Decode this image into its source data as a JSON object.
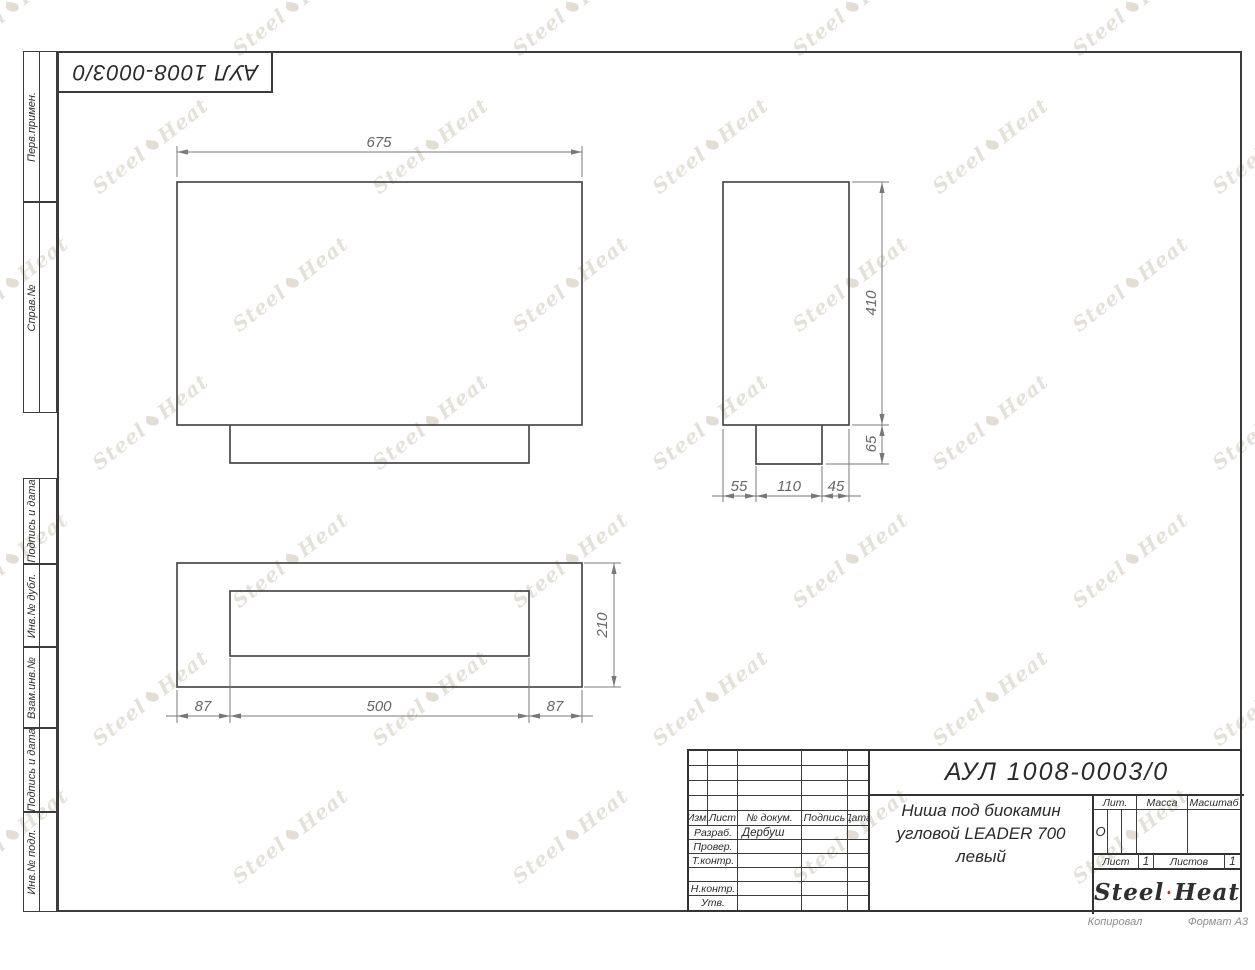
{
  "page": {
    "stamp_inverted": "АУЛ 1008-0003/0",
    "copied_label": "Копировал",
    "format_label": "Формат А3"
  },
  "sidebar": {
    "items": [
      {
        "label": "Перв.примен."
      },
      {
        "label": "Справ.№"
      },
      {
        "label": "Подпись и дата"
      },
      {
        "label": "Инв.№ дубл."
      },
      {
        "label": "Взам.инв.№"
      },
      {
        "label": "Подпись и дата"
      },
      {
        "label": "Инв.№ подл."
      }
    ]
  },
  "drawing": {
    "dimensions": {
      "front_width": "675",
      "side_height": "410",
      "foot_height": "65",
      "foot_left": "55",
      "foot_width": "110",
      "foot_right": "45",
      "depth": "210",
      "flange_left": "87",
      "opening_width": "500",
      "flange_right": "87"
    }
  },
  "title_block": {
    "designation": "АУЛ 1008-0003/0",
    "name_line1": "Ниша под биокамин",
    "name_line2": "угловой LEADER 700",
    "name_line3": "левый",
    "header": {
      "izm": "Изм.",
      "list": "Лист",
      "doc": "№ докум.",
      "sign": "Подпись",
      "date": "Дата"
    },
    "rows": {
      "razrab": "Разраб.",
      "razrab_name": "Дербуш",
      "prover": "Провер.",
      "tkontr": "Т.контр.",
      "nkontr": "Н.контр.",
      "utv": "Утв."
    },
    "lit_label": "Лит.",
    "lit_value": "О",
    "massa_label": "Масса",
    "masshtab_label": "Масштаб",
    "list_label": "Лист",
    "list_value": "1",
    "listov_label": "Листов",
    "listov_value": "1"
  },
  "logo": {
    "part1": "Steel",
    "part2": "Heat",
    "flame_color": "#e2301f",
    "text_color": "#2f2f2f"
  }
}
